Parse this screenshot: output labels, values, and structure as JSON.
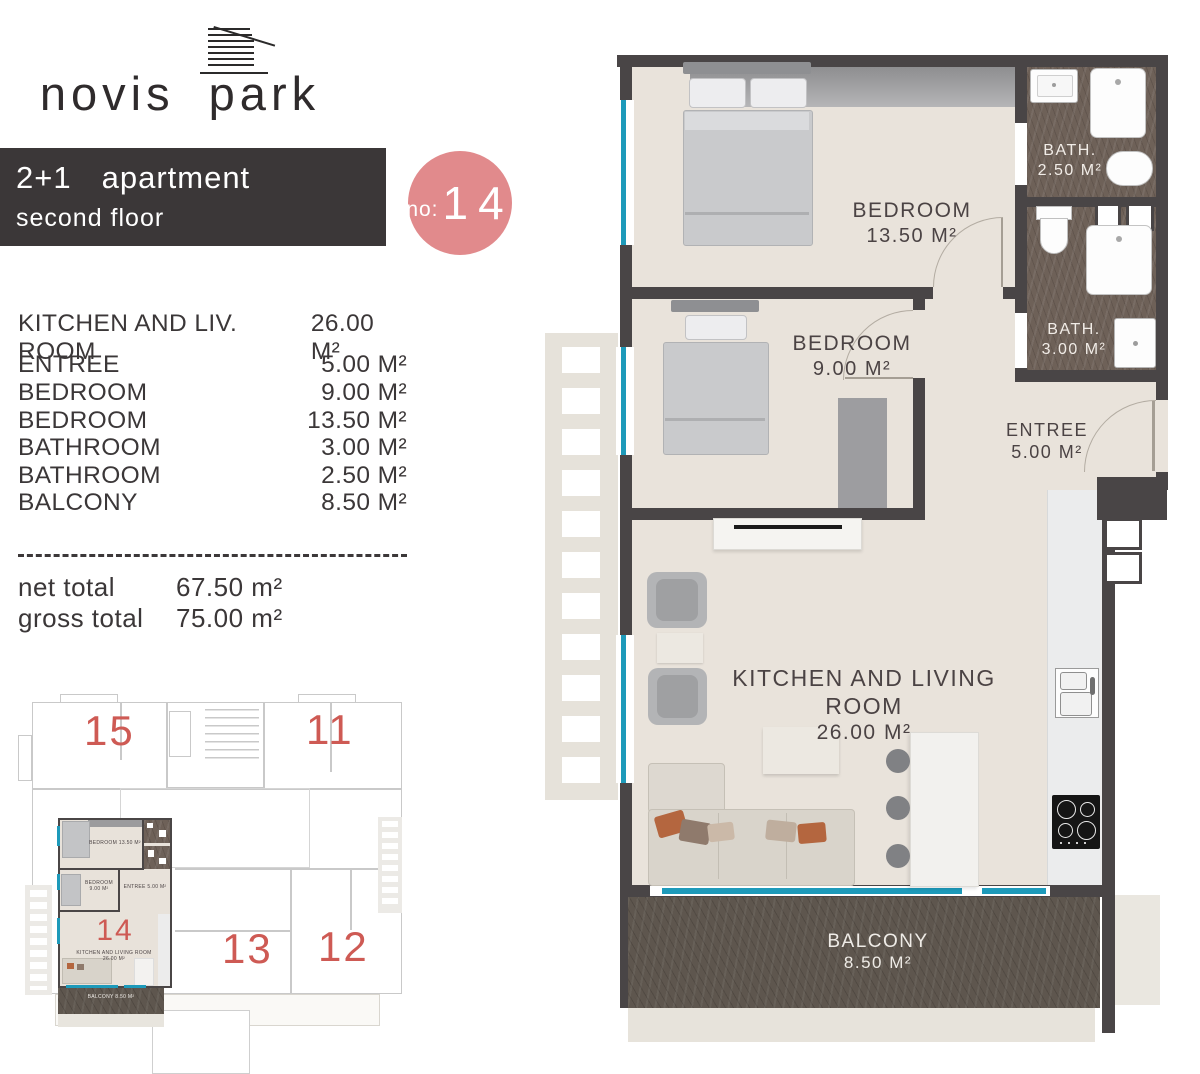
{
  "brand": {
    "logo_text": "novis park"
  },
  "banner": {
    "unit_type": "2+1",
    "title": "apartment",
    "subtitle": "second floor"
  },
  "unit_badge": {
    "prefix": "no:",
    "number": "14"
  },
  "room_list": {
    "rows": [
      {
        "name": "KITCHEN AND LIV. ROOM",
        "area": "26.00 M²"
      },
      {
        "name": "ENTREE",
        "area": "5.00 M²"
      },
      {
        "name": "BEDROOM",
        "area": "9.00 M²"
      },
      {
        "name": "BEDROOM",
        "area": "13.50 M²"
      },
      {
        "name": "BATHROOM",
        "area": "3.00 M²"
      },
      {
        "name": "BATHROOM",
        "area": "2.50 M²"
      },
      {
        "name": "BALCONY",
        "area": "8.50 M²"
      }
    ]
  },
  "totals": {
    "net_label": "net total",
    "net_value": "67.50 m²",
    "gross_label": "gross total",
    "gross_value": "75.00 m²"
  },
  "plan": {
    "bedroom_large": {
      "name": "BEDROOM",
      "area": "13.50 M²"
    },
    "bedroom_small": {
      "name": "BEDROOM",
      "area": "9.00 M²"
    },
    "bath_small": {
      "name": "BATH.",
      "area": "2.50 M²"
    },
    "bath_large": {
      "name": "BATH.",
      "area": "3.00 M²"
    },
    "entree": {
      "name": "ENTREE",
      "area": "5.00 M²"
    },
    "kitchen_living": {
      "name": "KITCHEN AND LIVING ROOM",
      "area": "26.00 M²"
    },
    "balcony": {
      "name": "BALCONY",
      "area": "8.50 M²"
    }
  },
  "key_plan": {
    "units": [
      {
        "number": "15"
      },
      {
        "number": "11"
      },
      {
        "number": "13"
      },
      {
        "number": "12"
      }
    ],
    "mini": {
      "number": "14",
      "bedroom_large": "BEDROOM 13.50 M²",
      "bedroom_small": "BEDROOM 9.00 M²",
      "entree": "ENTREE 5.00 M²",
      "kitchen": "KITCHEN AND LIVING ROOM 26.00 M²",
      "balcony": "BALCONY 8.50 M²"
    }
  },
  "colors": {
    "banner": "#3b3738",
    "badge_pink": "#e18a8c",
    "unit_number_red": "#ce5a54",
    "window_teal": "#1d9aba",
    "wall": "#494546",
    "floor": "#e9e3db",
    "bath_floor": "#6e6158",
    "balcony_floor": "#5e564e"
  }
}
